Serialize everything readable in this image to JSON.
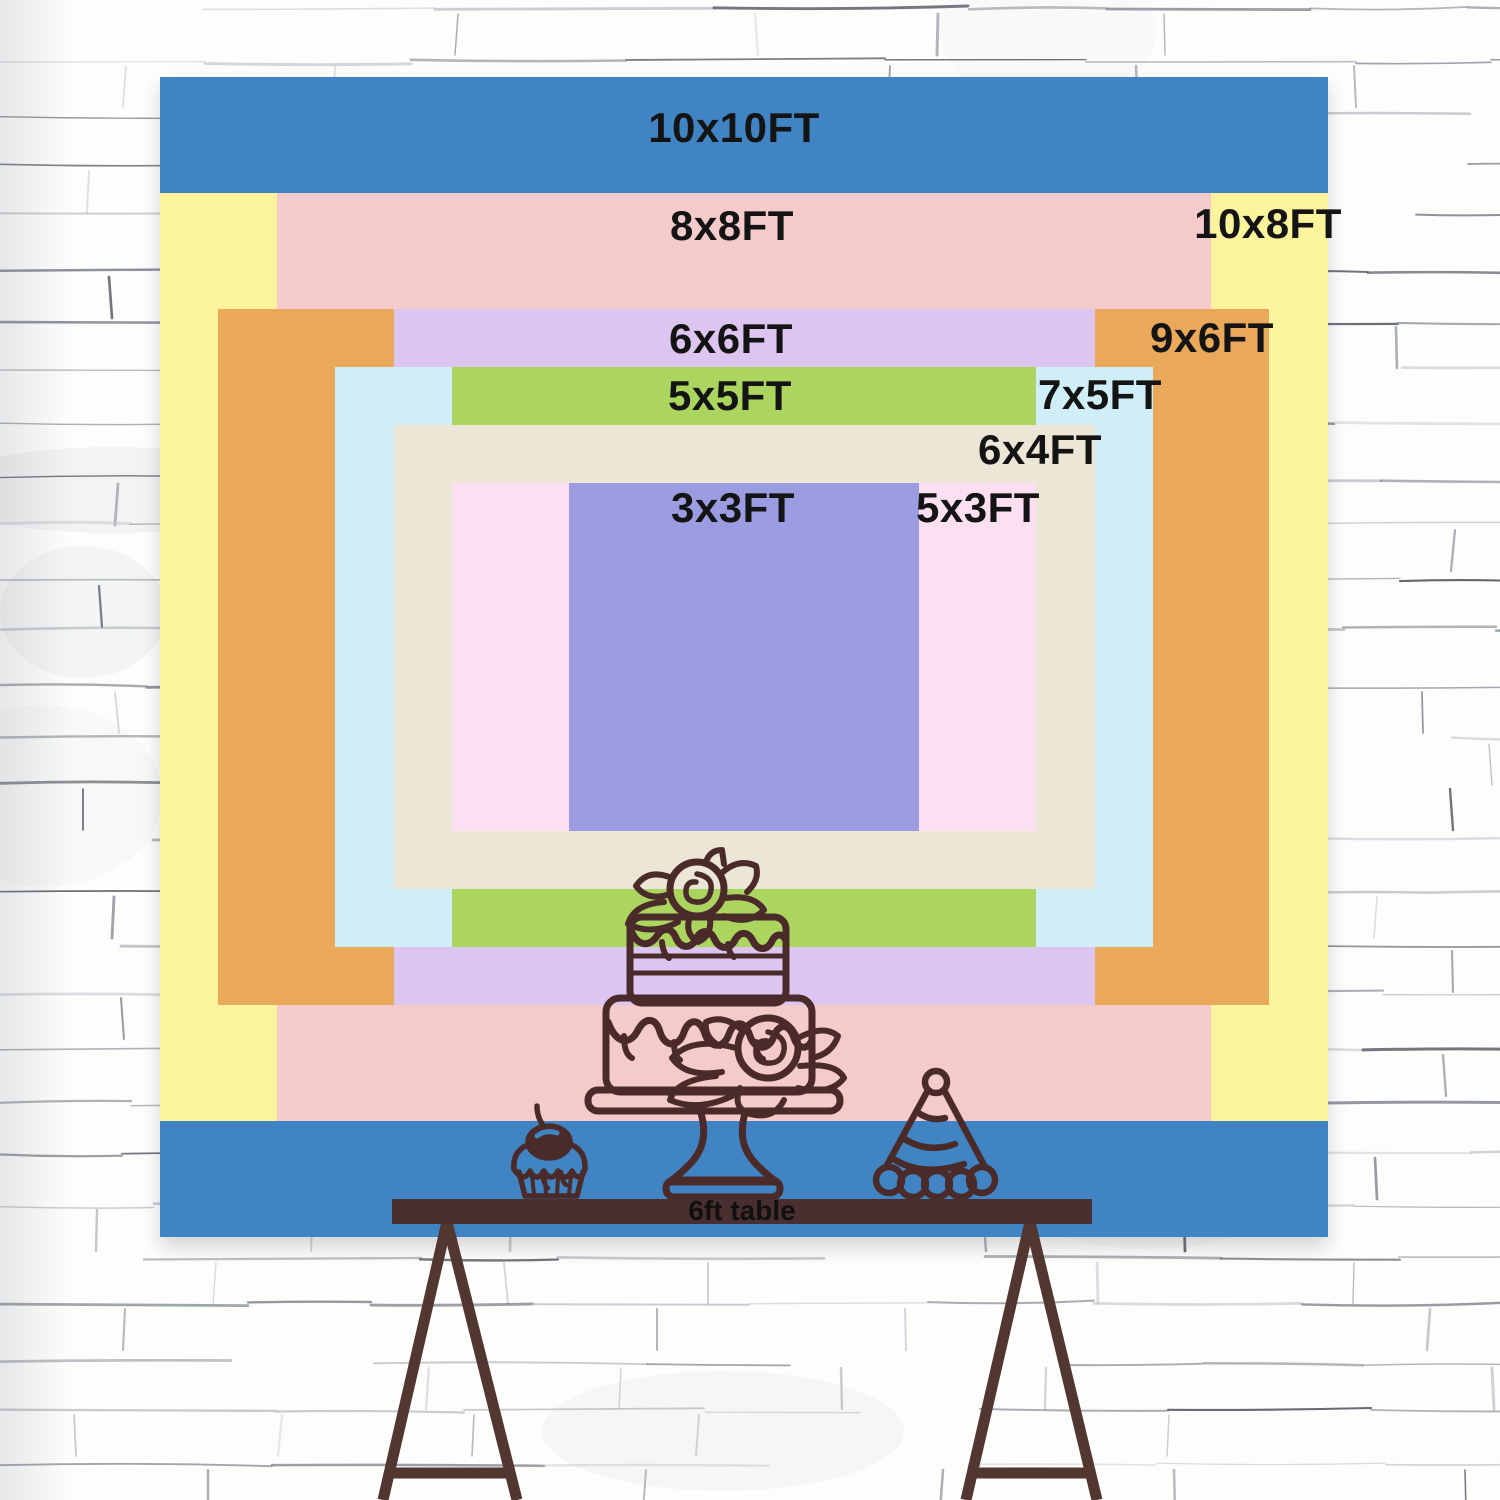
{
  "backdrop": {
    "label_text_color": "#141414",
    "sizes": [
      {
        "id": "10x10",
        "label": "10x10FT",
        "width_ft": 10,
        "height_ft": 10,
        "color": "#4184c4"
      },
      {
        "id": "10x8",
        "label": "10x8FT",
        "width_ft": 10,
        "height_ft": 8,
        "color": "#fbf49d"
      },
      {
        "id": "8x8",
        "label": "8x8FT",
        "width_ft": 8,
        "height_ft": 8,
        "color": "#f4caca"
      },
      {
        "id": "9x6",
        "label": "9x6FT",
        "width_ft": 9,
        "height_ft": 6,
        "color": "#eaa95a"
      },
      {
        "id": "6x6",
        "label": "6x6FT",
        "width_ft": 6,
        "height_ft": 6,
        "color": "#ddc5f1"
      },
      {
        "id": "7x5",
        "label": "7x5FT",
        "width_ft": 7,
        "height_ft": 5,
        "color": "#cfeef8"
      },
      {
        "id": "5x5",
        "label": "5x5FT",
        "width_ft": 5,
        "height_ft": 5,
        "color": "#acd560"
      },
      {
        "id": "6x4",
        "label": "6x4FT",
        "width_ft": 6,
        "height_ft": 4,
        "color": "#ebe6d6"
      },
      {
        "id": "5x3",
        "label": "5x3FT",
        "width_ft": 5,
        "height_ft": 3,
        "color": "#fcdff0"
      },
      {
        "id": "3x3",
        "label": "3x3FT",
        "width_ft": 3,
        "height_ft": 3,
        "color": "#9b9ce1"
      }
    ]
  },
  "table": {
    "label": "6ft table",
    "bar_color": "#4a2f31",
    "leg_color": "#523731",
    "text_color": "#101010"
  },
  "illustrations": {
    "stroke_color": "#4a2b29",
    "items": [
      "tiered-cake-icon",
      "cupcake-icon",
      "party-hat-icon"
    ]
  },
  "wall": {
    "background_color": "#fdfdfc",
    "line_color": "#9aa0a8"
  }
}
